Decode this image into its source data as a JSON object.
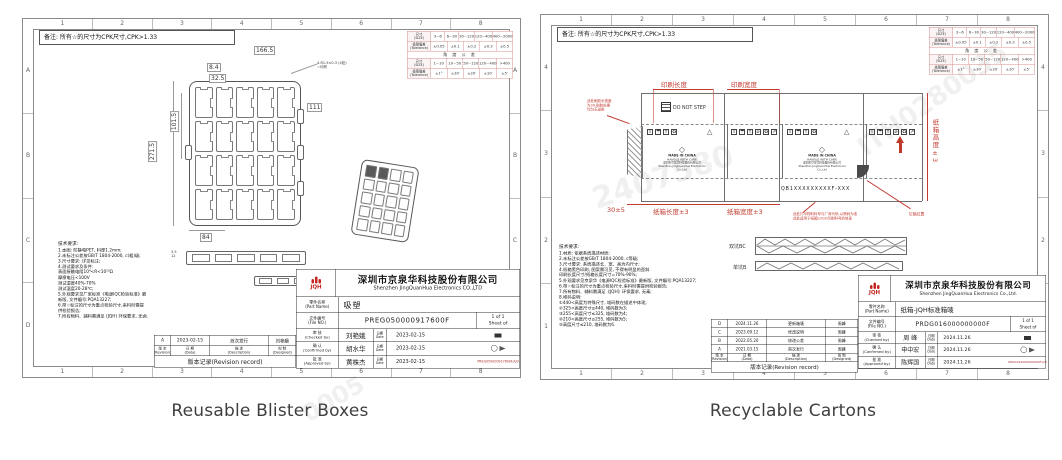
{
  "captions": {
    "left": "Reusable Blister Boxes",
    "right": "Recyclable Cartons"
  },
  "watermarks": {
    "wm1": "ITH0280035",
    "wm2": "2407580",
    "wm3": "0005"
  },
  "shared": {
    "note": "备注: 所有☆的尺寸为CPK尺寸,CPK>1.33",
    "cols": [
      "1",
      "2",
      "3",
      "4",
      "5",
      "6",
      "7",
      "8"
    ],
    "rows_letters": [
      "A",
      "B",
      "C",
      "D"
    ],
    "rows_numbers": [
      "4",
      "3",
      "2",
      "1"
    ],
    "tol": {
      "h_size": "尺寸\n(SIZE)",
      "h_tol": "极限偏差\n(Tolerance)",
      "size_range": [
        "3~6",
        "6~30",
        "30~120",
        "120~400",
        "400~2000"
      ],
      "size_tol": [
        "±0.05",
        "±0.1",
        "±0.2",
        "±0.3",
        "±0.5"
      ],
      "angle_band": "角 度 公 差",
      "angle_range": [
        "1~10",
        "10~50",
        "50~120",
        "120~400",
        ">400"
      ],
      "angle_tol": [
        "±1°",
        "±30′",
        "±20′",
        "±10′",
        "±5′"
      ]
    },
    "company_cn": "深圳市京泉华科技股份有限公司",
    "company_en": "Shenzhen JingQuanHua Electronics CO.,LTD",
    "company_en2": "Shenzhen JingQuanHua Electronics Co.,Ltd.",
    "logo_text": "JQH",
    "labels": {
      "part": "零件名称\n(Part Name)",
      "file": "文件编号\n(File NO.)",
      "sheet1": "1 of 1",
      "sheet2": "Sheet of",
      "date": "日期\nDate",
      "rev": "版 本\n(Revision)",
      "rdate": "日 期\n(Data)",
      "desc": "描 述\n(Description)",
      "designed": "拟 制\n(Designed)",
      "rev_title": "版本记录(Revision record)"
    }
  },
  "left": {
    "tech_title": "技术要求:",
    "tech_lines": [
      "1.本图: 防静电PET, 料厚1.2mm;",
      "2.未标注公差按GB/T 1804-2000, c(粗)级;",
      "3.尺寸要求: 详见标注;",
      "4.测试要求及条件:",
      "表面接触电阻10⁴<R<10¹⁰Ω",
      "摩擦电压<100V",
      "测试湿度40%-70%",
      "测试温度20-28℃;",
      "5.外观要求见厂家标准《电源IQC检验标准》最",
      "新版, 文件编号:PQA13227;",
      "6.带☆标注的尺寸为重点检验尺寸,来料时需提",
      "供检验报告;",
      "7.所有物料、辅料需满足 (JQH) 环保要求, 无卤."
    ],
    "dims": {
      "total_w": "166.5",
      "d1": "8.4",
      "d2": "32.5",
      "h1": "101.5",
      "h2": "271.5",
      "right": "111",
      "bottom": "84",
      "leader": "4-R1.5±0.3 (4处)\n☆均布",
      "p1": "3.5",
      "p2": "12"
    },
    "part_name": "吸塑",
    "file_no": "PREG050000917600F",
    "file_ref": "PREG050000917600F.A/0",
    "sign_rows": [
      {
        "role": "审 核\n(Checked by)",
        "name": "刘艳娥",
        "date": "2023-02-15"
      },
      {
        "role": "确 认\n(Confirmed by)",
        "name": "胡水华",
        "date": "2023-02-15"
      },
      {
        "role": "批 准\n(Approved by)",
        "name": "黄株杰",
        "date": "2023-02-15"
      }
    ],
    "rev_rows": [
      {
        "rev": "A",
        "date": "2023-02-15",
        "desc": "首次发行",
        "by": "刘艳娥"
      }
    ]
  },
  "right": {
    "tech_title": "技术要求:",
    "tech_lines": [
      "1.材质: 依据系统描述材质;",
      "2.未标注公差按GB/T 1804-2000, c等级;",
      "3.尺寸要求: 系统描述长、宽、高为内尺寸;",
      "4.纸箱黑色印刷, 图案需可见, 不得有明显的歪斜",
      "印刷长度尺寸/纸箱长度尺寸=70%-90%;",
      "5.外观要求见京泉华《电源IQC检验标准》最新版, 文件编号:PQA13227;",
      "6.带☆标注的尺寸为重点检验尺寸,来料时需提供检验报告;",
      "7.所有物料、辅料需满足《JQH》环保要求, 无毒;",
      "8.堆码说明:",
      "①440<高度为特殊尺寸, 堆码数在描述中体现;",
      "②325<高度尺寸≤440, 堆码数为3;",
      "③255<高度尺寸≤325, 堆码数为4;",
      "④210<高度尺寸≤255, 堆码数为5;",
      "⑤高度尺寸≤210, 堆码数为6."
    ],
    "part_name": "纸箱-JQH标准箱唛",
    "file_no": "PRDG016000000000F",
    "file_ref": "PRDG016000000000F.A/0",
    "sign_rows": [
      {
        "role": "审 核\n(Checked by)",
        "name": "周 峰",
        "date": "2024.11.26"
      },
      {
        "role": "确 认\n(Confirmed by)",
        "name": "申中宏",
        "date": "2024.11.26"
      },
      {
        "role": "批 准\n(Approved by)",
        "name": "陈辉国",
        "date": "2024.11.26"
      }
    ],
    "rev_rows": [
      {
        "rev": "D",
        "date": "2024.11.26",
        "desc": "更新箱唛",
        "by": "周峰"
      },
      {
        "rev": "C",
        "date": "2023.09.12",
        "desc": "修改说明",
        "by": "周峰"
      },
      {
        "rev": "B",
        "date": "2022.05.20",
        "desc": "修改公差",
        "by": "周峰"
      },
      {
        "rev": "A",
        "date": "2021.03.15",
        "desc": "首次发行",
        "by": "周峰"
      }
    ],
    "carton": {
      "print_len": "印刷长度",
      "print_wid": "印刷宽度",
      "len": "纸箱长度±3",
      "wid": "纸箱宽度±3",
      "hei": "纸箱高度±3",
      "glue": "30±5",
      "dns": "DO NOT STEP",
      "mark": {
        "l1": "MADE IN CHINA",
        "l2": "HANDLE WITH CARE",
        "l3": "深圳市京泉华科技股份有限公司",
        "l4": "Shenzhen JingQuanHua Electronics Co.,Ltd"
      },
      "code": "QB1XXXXXXXXXF-XXX",
      "glue_note": "此处刷胶水宽度\n为30,刷胶处需\n均匀无溢胶",
      "bottom_note": "此处打印物料料号与厂商代码,以喷码为准\n此处适用于纸箱LOGO印刷料号的信息",
      "nail_note": "钉箱位置",
      "wall2": "双坑BC",
      "wall1": "单坑B",
      "icons4": [
        "⇧",
        "☂",
        "Y",
        "♻"
      ],
      "icons6": [
        "⇧",
        "☂",
        "Y",
        "⌀",
        "♻",
        "⇗"
      ],
      "warn": "△"
    }
  }
}
